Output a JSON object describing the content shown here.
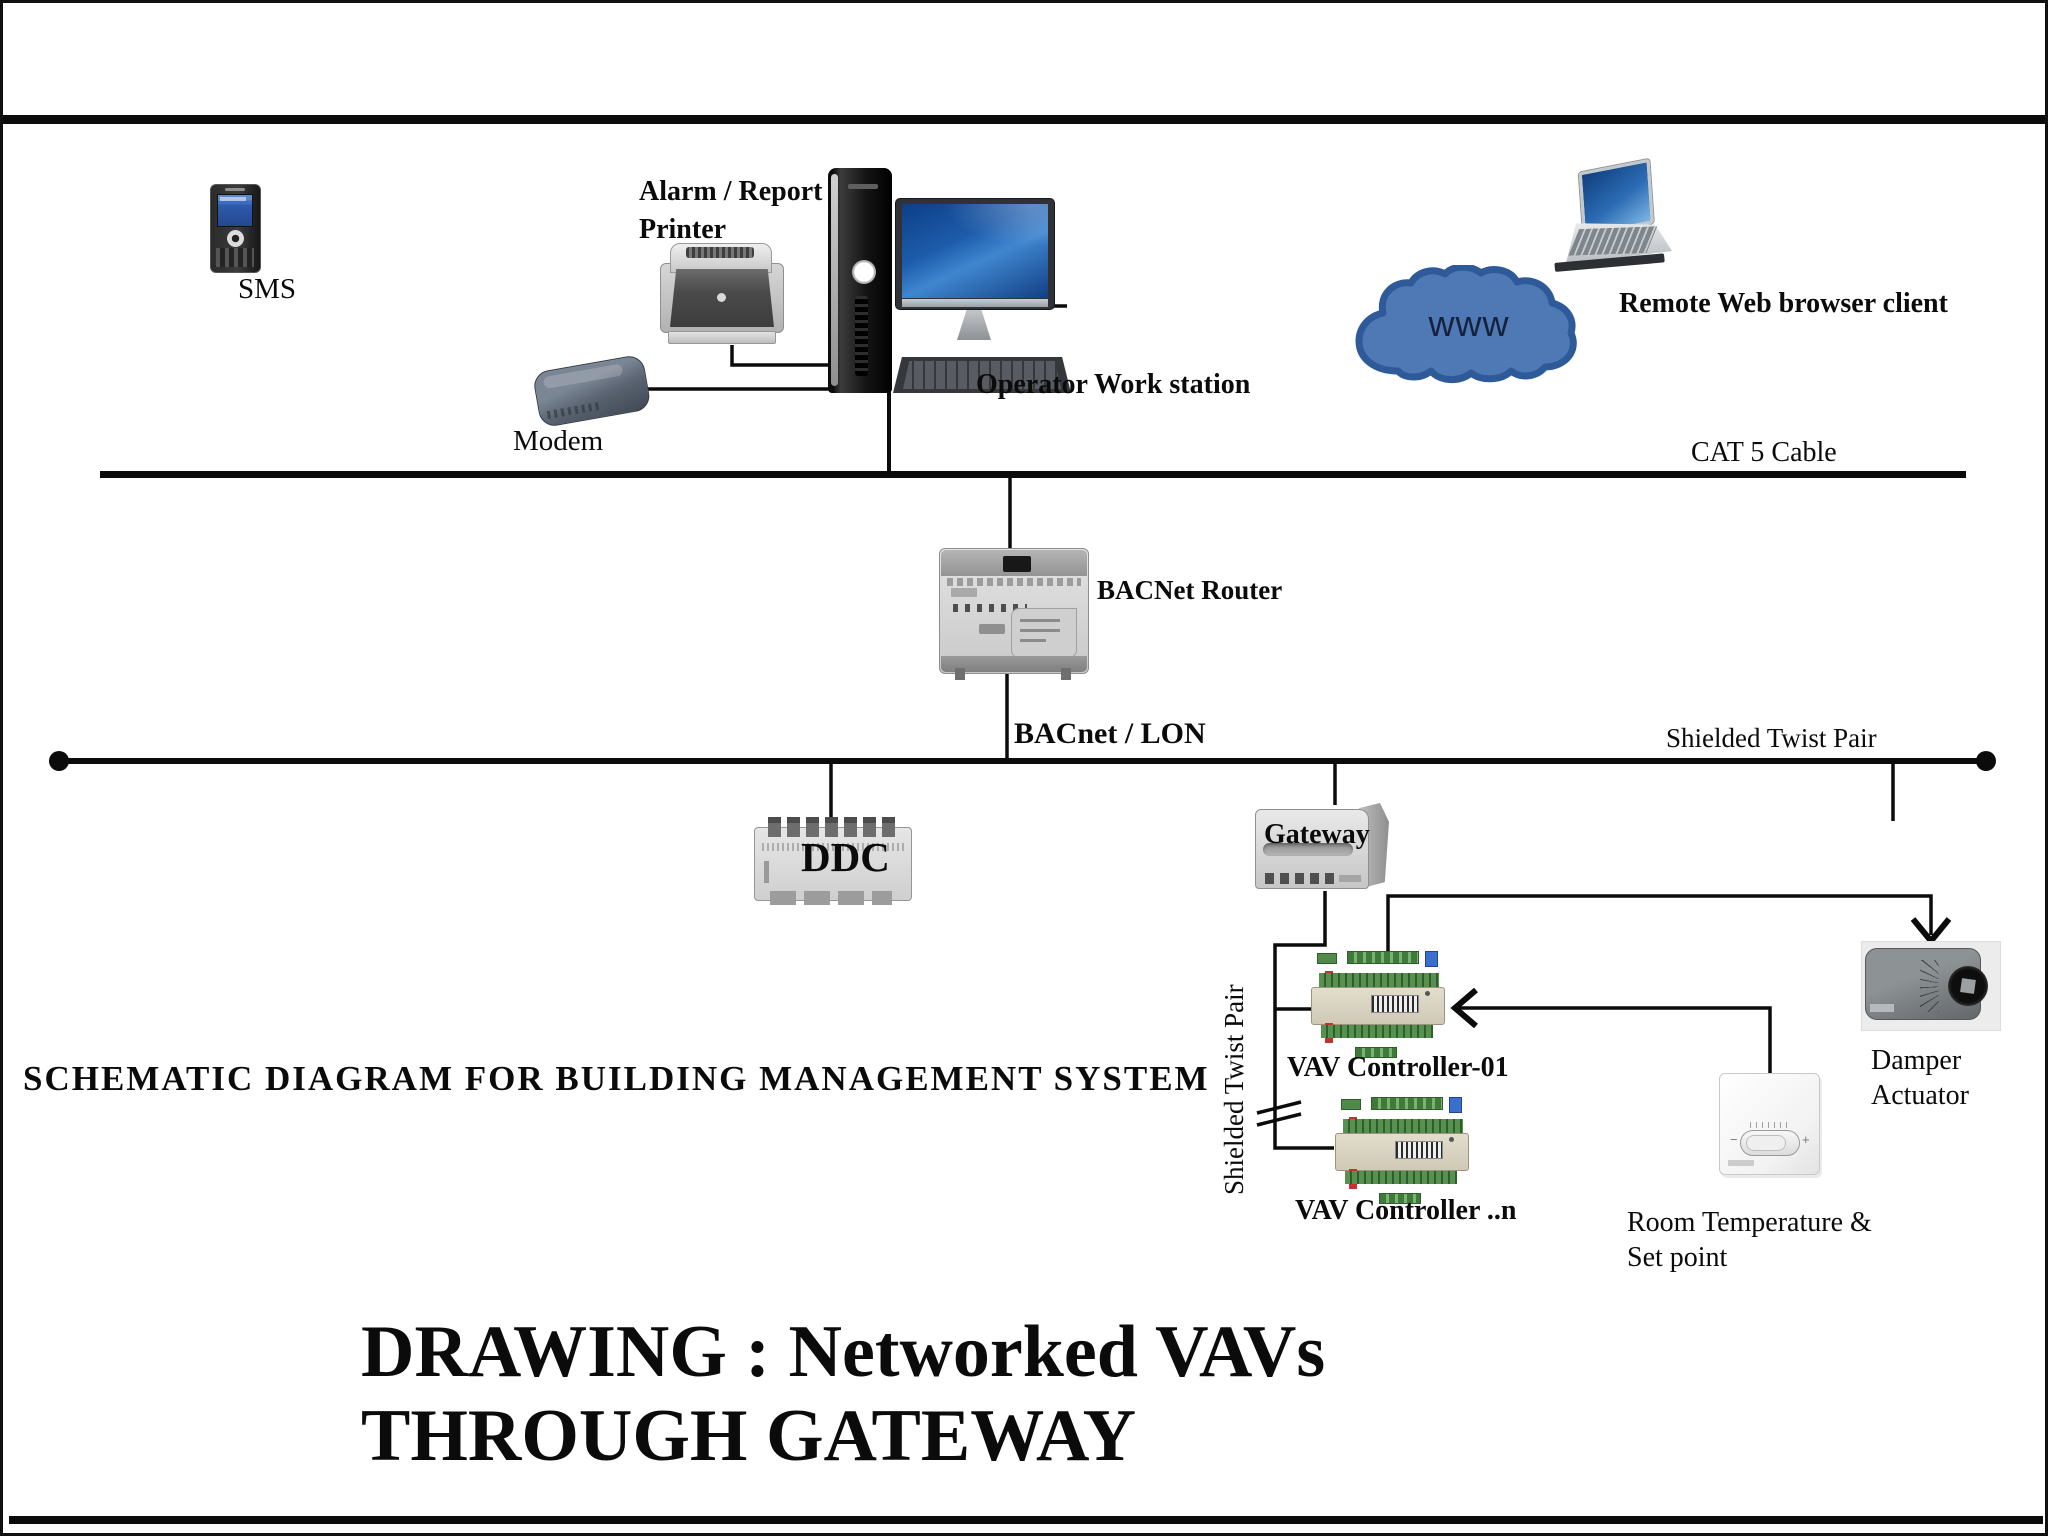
{
  "diagram": {
    "heading": "SCHEMATIC DIAGRAM FOR BUILDING MANAGEMENT SYSTEM",
    "title_line1": "DRAWING : Networked VAVs",
    "title_line2": "THROUGH GATEWAY",
    "nodes": {
      "sms": {
        "label": "SMS"
      },
      "printer": {
        "label_line1": "Alarm / Report",
        "label_line2": "Printer"
      },
      "modem": {
        "label": "Modem"
      },
      "workstation": {
        "label": "Operator Work station"
      },
      "cloud": {
        "label": "www"
      },
      "remote_client": {
        "label": "Remote Web browser client"
      },
      "router": {
        "label": "BACNet Router"
      },
      "ddc": {
        "label": "DDC"
      },
      "gateway": {
        "label": "Gateway"
      },
      "vav01": {
        "label": "VAV Controller-01"
      },
      "vavn": {
        "label": "VAV Controller ..n"
      },
      "damper": {
        "label_line1": "Damper",
        "label_line2": "Actuator"
      },
      "room_temp": {
        "label_line1": "Room Temperature &",
        "label_line2": "Set point"
      }
    },
    "cables": {
      "cat5": {
        "label": "CAT 5 Cable"
      },
      "bacnet_lon": {
        "label": "BACnet / LON"
      },
      "stp_right": {
        "label": "Shielded Twist Pair"
      },
      "stp_vertical": {
        "label": "Shielded Twist Pair"
      }
    },
    "colors": {
      "line_black": "#0b0b0b",
      "cloud_fill": "#4f79b5",
      "cloud_stroke": "#2e5a99",
      "screen_blue": "#2c6cb4",
      "terminal_green": "#57904f",
      "vav_beige": "#ddd6c4"
    }
  }
}
